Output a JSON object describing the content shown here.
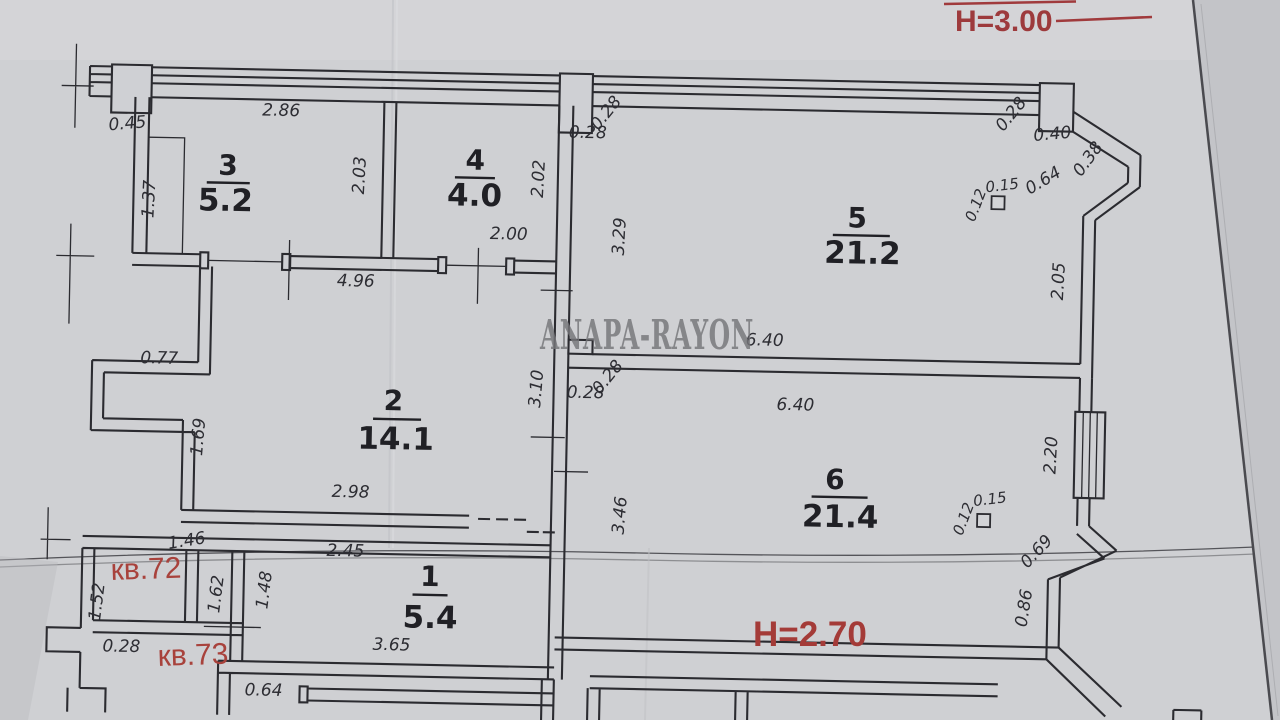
{
  "watermark": "ANAPA-RAYON",
  "annotations": {
    "height_top": "Н=3.00",
    "height_bottom": "Н=2.70",
    "apt_72": "кв.72",
    "apt_73": "кв.73"
  },
  "rooms": [
    {
      "number": "1",
      "area": "5.4"
    },
    {
      "number": "2",
      "area": "14.1"
    },
    {
      "number": "3",
      "area": "5.2"
    },
    {
      "number": "4",
      "area": "4.0"
    },
    {
      "number": "5",
      "area": "21.2"
    },
    {
      "number": "6",
      "area": "21.4"
    }
  ],
  "dimensions": {
    "top_286": "2.86",
    "niche_045": "0.45",
    "duct_137": "1.37",
    "room3_h_203": "2.03",
    "room4_h_202": "2.02",
    "door4_200": "2.00",
    "hall_496": "4.96",
    "coltop_028a": "0.28",
    "coltop_028b": "0.28",
    "room5_329": "3.29",
    "wall56_640a": "6.40",
    "wall56_640b": "6.40",
    "bay_028": "0.28",
    "bay_040": "0.40",
    "bay_038": "0.38",
    "bay_064": "0.64",
    "col5_012": "0.12",
    "col5_015": "0.15",
    "right5_205": "2.05",
    "corr_310": "3.10",
    "corr_028a": "0.28",
    "corr_028b": "0.28",
    "room6_346": "3.46",
    "niche_077": "0.77",
    "room2_169": "1.69",
    "room2_298": "2.98",
    "col6_012": "0.12",
    "col6_015": "0.15",
    "win6_220": "2.20",
    "bay6_069": "0.69",
    "bay6_086": "0.86",
    "shaft_146": "1.46",
    "room1_245": "2.45",
    "shaft_152": "1.52",
    "shaft_162": "1.62",
    "room1_148": "1.48",
    "shaft_028": "0.28",
    "room1_365": "3.65",
    "pass_064": "0.64"
  },
  "colors": {
    "paper": "#cfd0d3",
    "ink": "#2b2b30",
    "red": "#a03a3c",
    "watermark": "#76767a"
  }
}
